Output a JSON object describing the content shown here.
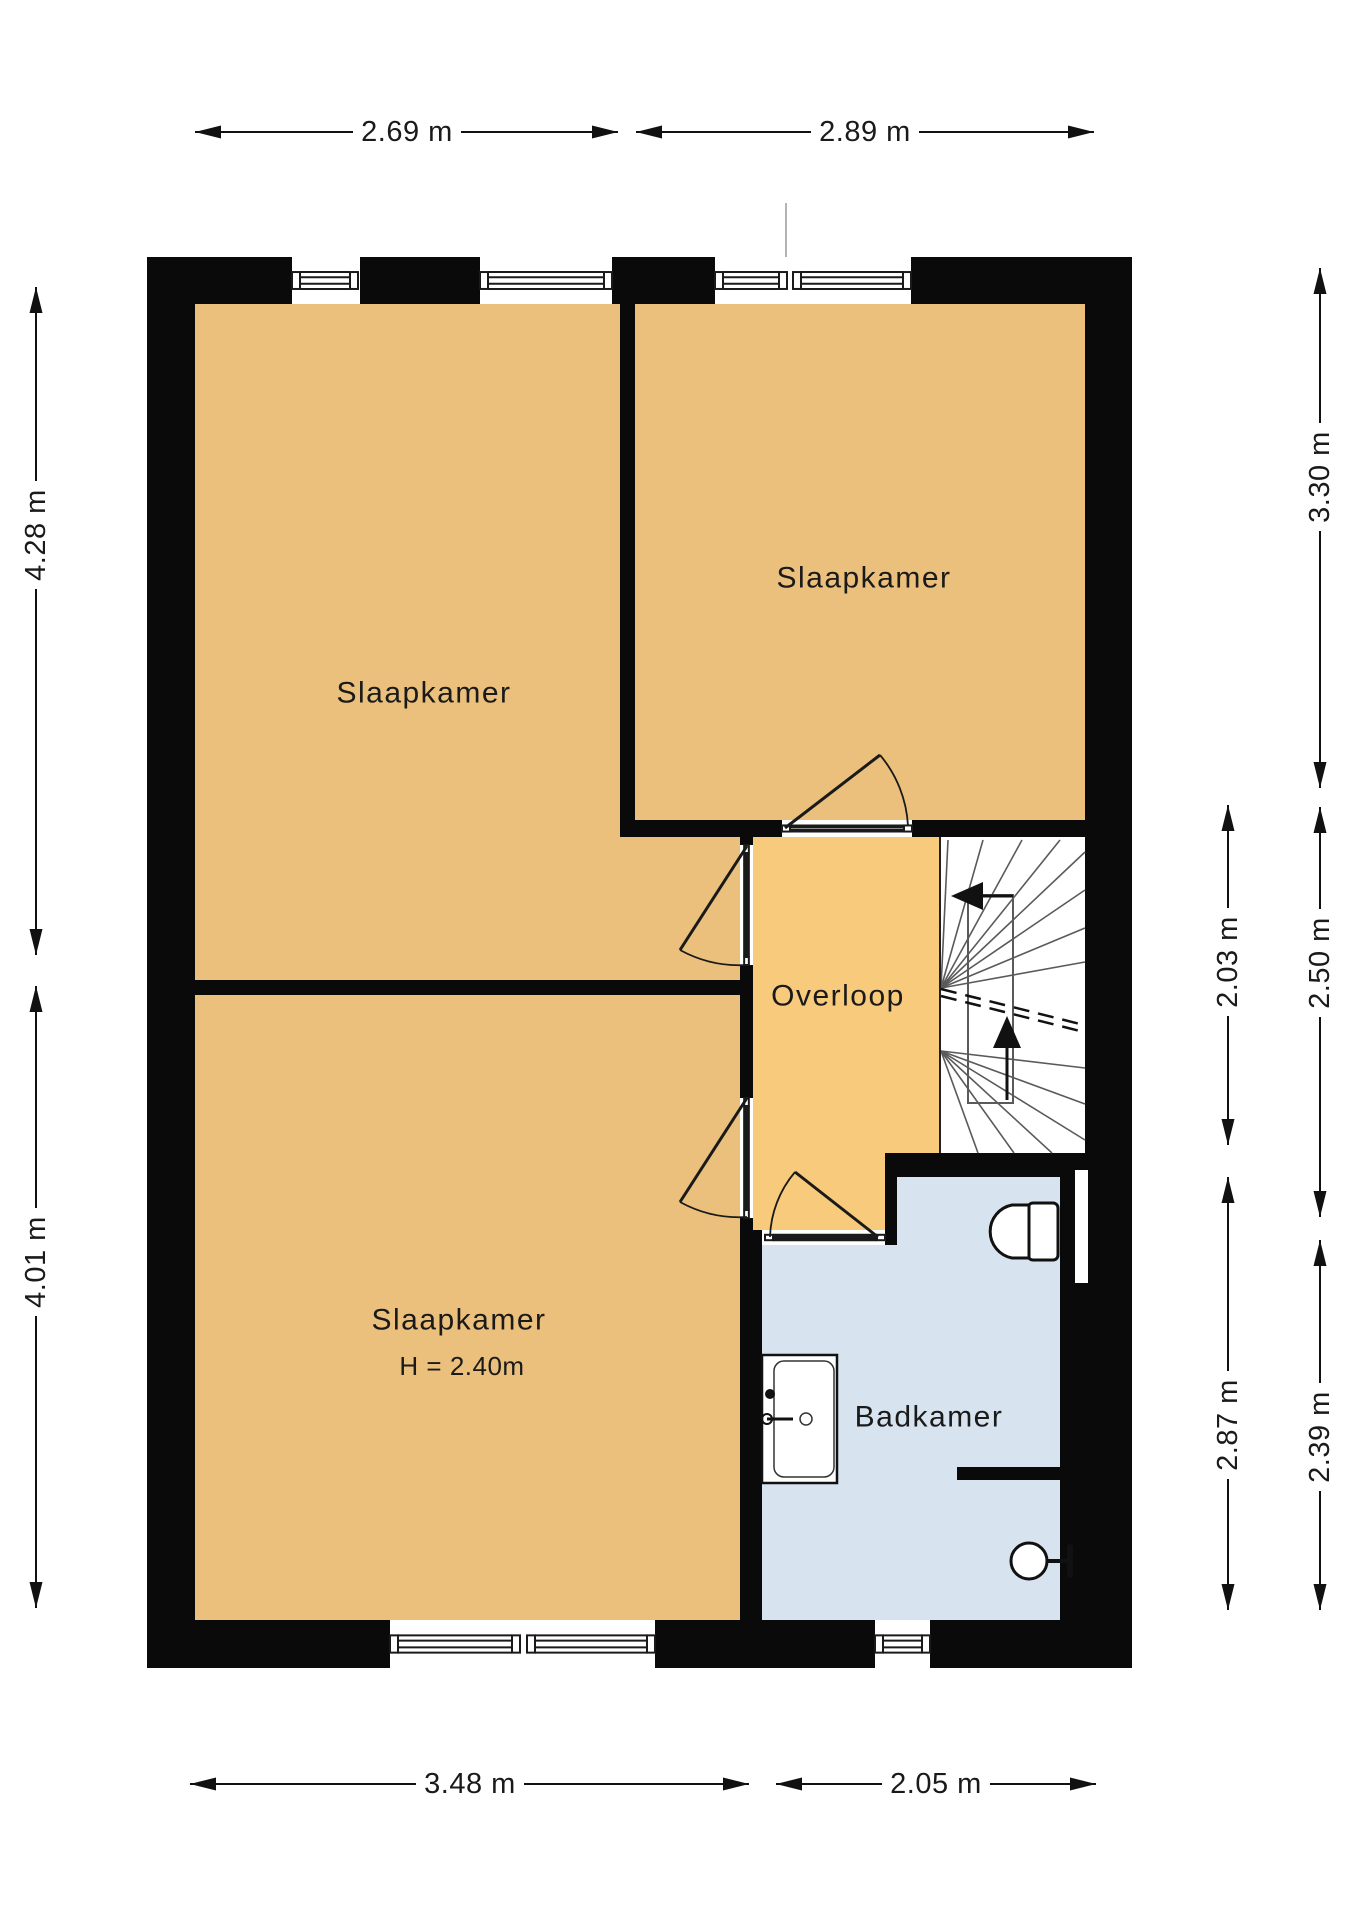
{
  "title": "Verdieping plattegrond (floor plan)",
  "colors": {
    "bedroom_fill": "#EBC07C",
    "landing_fill": "#F8CB7C",
    "bathroom_fill": "#D8E3F0",
    "stairs_fill": "#FFFFFF",
    "wall": "#0A0A0A",
    "line": "#1A1A1A",
    "stair_line": "#5A5A5A",
    "faint_line": "#9A9A9A",
    "text": "#1A1A1A"
  },
  "rooms": [
    {
      "id": "slaapkamer-1",
      "label": "Slaapkamer",
      "fill": "bedroom_fill",
      "points": "195,304 627,304 627,837 740,837 740,980 195,980",
      "label_x": 424,
      "label_y": 693
    },
    {
      "id": "slaapkamer-2",
      "label": "Slaapkamer",
      "fill": "bedroom_fill",
      "points": "627,304 1085,304 1085,837 627,837",
      "label_x": 864,
      "label_y": 578
    },
    {
      "id": "slaapkamer-3",
      "label": "Slaapkamer",
      "sublabel": "H = 2.40m",
      "fill": "bedroom_fill",
      "points": "195,995 740,995 740,1620 195,1620",
      "label_x": 459,
      "label_y": 1320,
      "sub_x": 462,
      "sub_y": 1366
    },
    {
      "id": "overloop",
      "label": "Overloop",
      "fill": "landing_fill",
      "points": "740,837 940,837 940,1153 897,1153 897,1230 740,1230",
      "label_x": 838,
      "label_y": 996
    },
    {
      "id": "badkamer",
      "label": "Badkamer",
      "fill": "bathroom_fill",
      "points": "897,1177 1060,1177 1060,1620 762,1620 762,1245 897,1245",
      "label_x": 929,
      "label_y": 1417
    },
    {
      "id": "trapgat",
      "label": "",
      "fill": "stairs_fill",
      "points": "940,837 1085,837 1085,1153 940,1153",
      "label_x": 0,
      "label_y": 0
    }
  ],
  "walls": [
    [
      147,
      257,
      145,
      47
    ],
    [
      360,
      257,
      120,
      47
    ],
    [
      612,
      257,
      103,
      47
    ],
    [
      911,
      257,
      221,
      47
    ],
    [
      147,
      257,
      48,
      1411
    ],
    [
      1085,
      257,
      47,
      896
    ],
    [
      1060,
      1153,
      72,
      515
    ],
    [
      147,
      1620,
      243,
      48
    ],
    [
      655,
      1620,
      220,
      48
    ],
    [
      930,
      1620,
      202,
      48
    ],
    [
      620,
      304,
      15,
      516
    ],
    [
      620,
      820,
      162,
      17
    ],
    [
      912,
      820,
      173,
      17
    ],
    [
      195,
      980,
      558,
      15
    ],
    [
      740,
      837,
      13,
      8
    ],
    [
      740,
      965,
      13,
      133
    ],
    [
      740,
      1218,
      13,
      12
    ],
    [
      740,
      1230,
      22,
      390
    ],
    [
      885,
      1153,
      12,
      92
    ],
    [
      897,
      1153,
      188,
      24
    ],
    [
      957,
      1467,
      103,
      13
    ]
  ],
  "windows": [
    {
      "id": "window-top-1",
      "o": "h",
      "x": 292,
      "y": 257,
      "w": 66,
      "h": 47
    },
    {
      "id": "window-top-2",
      "o": "h",
      "x": 480,
      "y": 257,
      "w": 132,
      "h": 47
    },
    {
      "id": "window-top-3",
      "o": "h",
      "x": 715,
      "y": 257,
      "w": 72,
      "h": 47
    },
    {
      "id": "window-top-4",
      "o": "h",
      "x": 793,
      "y": 257,
      "w": 118,
      "h": 47
    },
    {
      "id": "window-bottom-1",
      "o": "h",
      "x": 390,
      "y": 1620,
      "w": 130,
      "h": 48
    },
    {
      "id": "window-bottom-2",
      "o": "h",
      "x": 527,
      "y": 1620,
      "w": 128,
      "h": 48
    },
    {
      "id": "window-bathroom",
      "o": "h",
      "x": 875,
      "y": 1620,
      "w": 55,
      "h": 48
    },
    {
      "id": "doorsill-slaapkamer-2",
      "o": "h",
      "x": 782,
      "y": 820,
      "w": 130,
      "h": 17
    },
    {
      "id": "doorsill-badkamer",
      "o": "h",
      "x": 765,
      "y": 1230,
      "w": 120,
      "h": 15
    },
    {
      "id": "doorsill-slaapkamer-1",
      "o": "v",
      "x": 740,
      "y": 845,
      "w": 13,
      "h": 120
    },
    {
      "id": "doorsill-slaapkamer-3",
      "o": "v",
      "x": 740,
      "y": 1098,
      "w": 13,
      "h": 120
    }
  ],
  "doors": [
    {
      "id": "door-slaapkamer-2",
      "hinge": [
        785,
        828
      ],
      "leaf": [
        880,
        755
      ],
      "end": [
        908,
        826
      ],
      "sweep": 1
    },
    {
      "id": "door-slaapkamer-1",
      "hinge": [
        747,
        846
      ],
      "leaf": [
        680,
        950
      ],
      "end": [
        747,
        965
      ],
      "sweep": 0
    },
    {
      "id": "door-slaapkamer-3",
      "hinge": [
        747,
        1098
      ],
      "leaf": [
        680,
        1202
      ],
      "end": [
        747,
        1217
      ],
      "sweep": 0
    },
    {
      "id": "door-badkamer",
      "hinge": [
        878,
        1237
      ],
      "leaf": [
        795,
        1172
      ],
      "end": [
        770,
        1237
      ],
      "sweep": 0
    }
  ],
  "stairs": {
    "edge": [
      940,
      837,
      940,
      1153
    ],
    "newel": [
      968,
      895,
      45,
      208
    ],
    "rays": [
      [
        941,
        988,
        948,
        840
      ],
      [
        941,
        988,
        983,
        840
      ],
      [
        941,
        988,
        1022,
        840
      ],
      [
        941,
        988,
        1060,
        840
      ],
      [
        941,
        988,
        1085,
        852
      ],
      [
        941,
        988,
        1085,
        890
      ],
      [
        941,
        988,
        1085,
        928
      ],
      [
        941,
        988,
        1085,
        962
      ],
      [
        941,
        1051,
        1085,
        1068
      ],
      [
        941,
        1051,
        1085,
        1104
      ],
      [
        941,
        1051,
        1085,
        1140
      ],
      [
        941,
        1051,
        1052,
        1153
      ],
      [
        941,
        1051,
        1014,
        1153
      ],
      [
        941,
        1051,
        978,
        1153
      ]
    ],
    "cut": [
      [
        941,
        989,
        1084,
        1025
      ],
      [
        941,
        996,
        1084,
        1032
      ]
    ],
    "arrow_up": {
      "shaft": [
        1007,
        1100,
        1007,
        1044
      ],
      "head": [
        [
          1007,
          1016
        ],
        [
          993,
          1048
        ],
        [
          1021,
          1048
        ]
      ]
    },
    "arrow_left": {
      "shaft": [
        1013,
        896,
        981,
        896
      ],
      "head": [
        [
          951,
          896
        ],
        [
          983,
          882
        ],
        [
          983,
          910
        ]
      ]
    }
  },
  "fixtures": {
    "toilet": {
      "tank": [
        1028,
        1203,
        30,
        57
      ],
      "bowl": "M 1029 1205 L 1012 1205 A 27 27 0 0 0 1012 1258 L 1029 1258 Z"
    },
    "basin": {
      "outer": [
        762,
        1355,
        75,
        128
      ],
      "inner": [
        774,
        1361,
        60,
        116
      ],
      "dot": [
        770,
        1394,
        5
      ],
      "faucet_base": [
        767,
        1419,
        5
      ],
      "faucet_line": [
        767,
        1419,
        793,
        1419
      ],
      "drain": [
        806,
        1419,
        6
      ]
    },
    "shower": {
      "head": [
        1029,
        1561,
        18
      ],
      "arm": [
        1047,
        1561,
        1070,
        1561
      ],
      "bar": [
        1070,
        1547,
        1070,
        1575
      ]
    },
    "niche": [
      1075,
      1170,
      13,
      113
    ],
    "party_line": [
      786,
      203,
      786,
      257
    ]
  },
  "dimensions": [
    {
      "id": "dim-top-left",
      "dir": "h",
      "x1": 195,
      "x2": 618,
      "pos": 132,
      "label": "2.69 m",
      "t": 407
    },
    {
      "id": "dim-top-right",
      "dir": "h",
      "x1": 636,
      "x2": 1094,
      "pos": 132,
      "label": "2.89 m",
      "t": 865
    },
    {
      "id": "dim-bottom-left",
      "dir": "h",
      "x1": 190,
      "x2": 749,
      "pos": 1784,
      "label": "3.48 m",
      "t": 470
    },
    {
      "id": "dim-bottom-right",
      "dir": "h",
      "x1": 776,
      "x2": 1096,
      "pos": 1784,
      "label": "2.05 m",
      "t": 936
    },
    {
      "id": "dim-left-upper",
      "dir": "v",
      "y1": 287,
      "y2": 955,
      "pos": 36,
      "label": "4.28 m",
      "t": 535
    },
    {
      "id": "dim-left-lower",
      "dir": "v",
      "y1": 986,
      "y2": 1608,
      "pos": 36,
      "label": "4.01 m",
      "t": 1262
    },
    {
      "id": "dim-right-inner-upper",
      "dir": "v",
      "y1": 805,
      "y2": 1145,
      "pos": 1228,
      "label": "2.03 m",
      "t": 962
    },
    {
      "id": "dim-right-inner-lower",
      "dir": "v",
      "y1": 1177,
      "y2": 1610,
      "pos": 1228,
      "label": "2.87 m",
      "t": 1425
    },
    {
      "id": "dim-right-outer-upper",
      "dir": "v",
      "y1": 268,
      "y2": 788,
      "pos": 1320,
      "label": "3.30 m",
      "t": 477
    },
    {
      "id": "dim-right-outer-middle",
      "dir": "v",
      "y1": 807,
      "y2": 1217,
      "pos": 1320,
      "label": "2.50 m",
      "t": 963
    },
    {
      "id": "dim-right-outer-lower",
      "dir": "v",
      "y1": 1240,
      "y2": 1610,
      "pos": 1320,
      "label": "2.39 m",
      "t": 1437
    }
  ]
}
